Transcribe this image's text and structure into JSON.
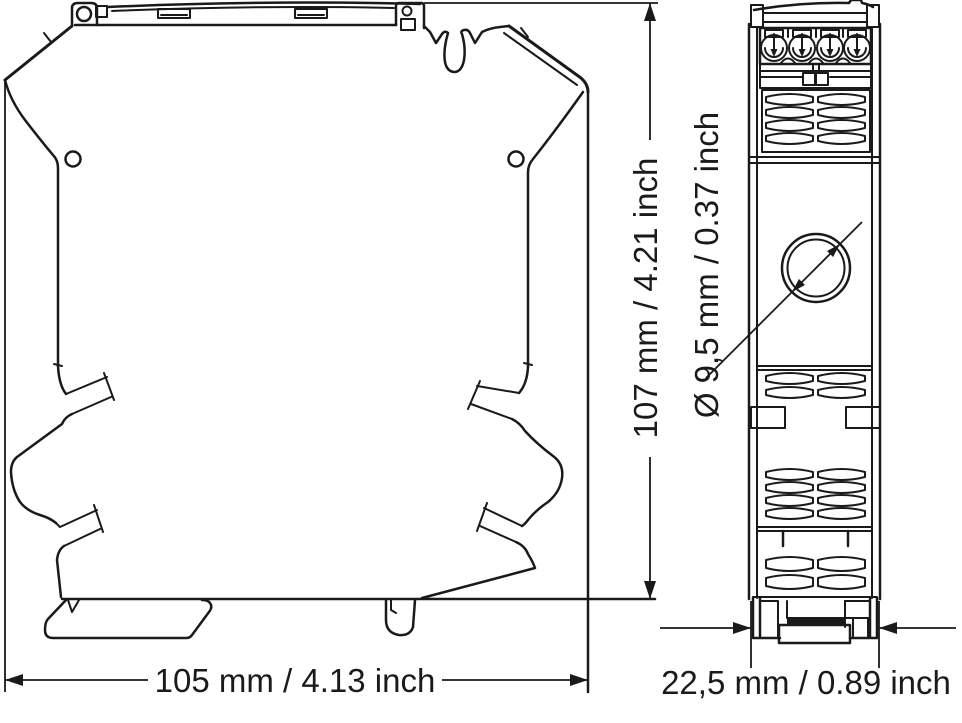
{
  "drawing": {
    "title": "DIN-rail module dimensional drawing",
    "views": [
      "side-view",
      "front-view"
    ],
    "colors": {
      "line": "#1a1a1a",
      "background": "#ffffff"
    },
    "dimensions": {
      "width": {
        "label": "105 mm / 4.13 inch",
        "mm": 105,
        "inch": 4.13
      },
      "height": {
        "label": "107 mm / 4.21 inch",
        "mm": 107,
        "inch": 4.21
      },
      "hole_diameter": {
        "label": "Ø 9,5 mm / 0.37 inch",
        "mm": 9.5,
        "inch": 0.37
      },
      "depth": {
        "label": "22,5 mm / 0.89 inch",
        "mm": 22.5,
        "inch": 0.89
      }
    }
  }
}
